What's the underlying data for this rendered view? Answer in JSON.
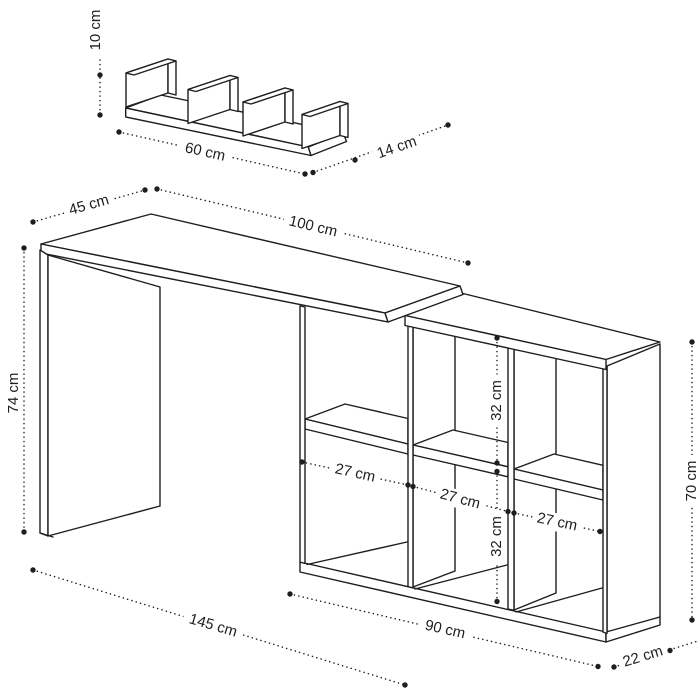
{
  "colors": {
    "background": "#ffffff",
    "line": "#1e1e1e",
    "text": "#1e1e1e"
  },
  "wall_shelf": {
    "dimensions": {
      "height": {
        "label": "10 cm"
      },
      "width": {
        "label": "60 cm"
      },
      "depth": {
        "label": "14 cm"
      }
    }
  },
  "desk": {
    "dimensions": {
      "depth": {
        "label": "45 cm"
      },
      "width": {
        "label": "100 cm"
      },
      "height": {
        "label": "74 cm"
      }
    }
  },
  "shelf_unit": {
    "dimensions": {
      "top_cell_height": {
        "label": "32 cm"
      },
      "bottom_cell_height": {
        "label": "32 cm"
      },
      "cell1_width": {
        "label": "27 cm"
      },
      "cell2_width": {
        "label": "27 cm"
      },
      "cell3_width": {
        "label": "27 cm"
      },
      "height": {
        "label": "70 cm"
      },
      "width": {
        "label": "90 cm"
      },
      "depth": {
        "label": "22 cm"
      }
    }
  },
  "overall": {
    "dimensions": {
      "total_width": {
        "label": "145 cm"
      }
    }
  }
}
